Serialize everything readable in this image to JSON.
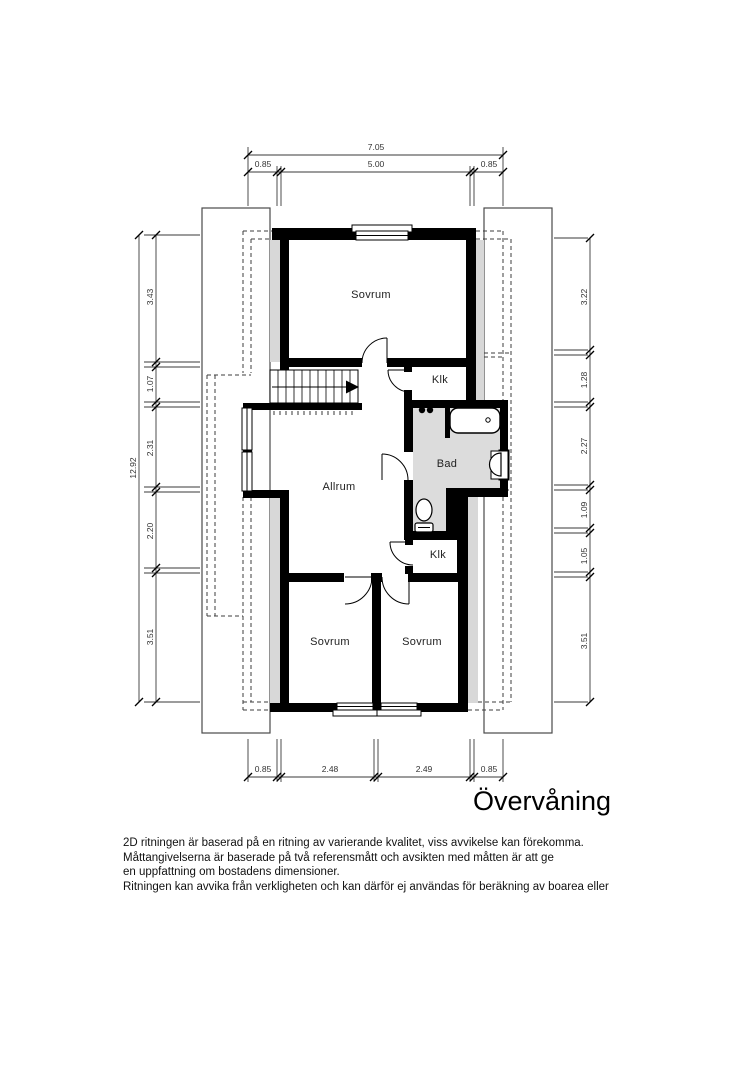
{
  "title": "Övervåning",
  "rooms": {
    "sovrum_top": "Sovrum",
    "klk_top": "Klk",
    "bad": "Bad",
    "allrum": "Allrum",
    "klk_bottom": "Klk",
    "sovrum_bottom_left": "Sovrum",
    "sovrum_bottom_right": "Sovrum"
  },
  "dimensions": {
    "top": {
      "total": "7.05",
      "segments": [
        "0.85",
        "5.00",
        "0.85"
      ]
    },
    "bottom": {
      "segments": [
        "0.85",
        "2.48",
        "2.49",
        "0.85"
      ]
    },
    "left": {
      "total": "12.92",
      "segments": [
        "3.43",
        "1.07",
        "2.31",
        "2.20",
        "3.51"
      ]
    },
    "right": {
      "segments": [
        "3.22",
        "1.28",
        "2.27",
        "1.09",
        "1.05",
        "3.51"
      ]
    }
  },
  "disclaimer": {
    "line1": "2D ritningen är baserad på en ritning av varierande kvalitet, viss avvikelse kan förekomma.",
    "line2": "Måttangivelserna är baserade på två referensmått och avsikten med måtten är att ge",
    "line3": "en uppfattning om bostadens dimensioner.",
    "line4": "Ritningen kan avvika från verkligheten och kan därför ej användas för beräkning av boarea eller"
  },
  "colors": {
    "wall": "#000000",
    "low_ceiling_zone": "#d8d8d8",
    "bathroom_floor": "#dcdcdc",
    "dimension_line": "#3a3a3a"
  }
}
